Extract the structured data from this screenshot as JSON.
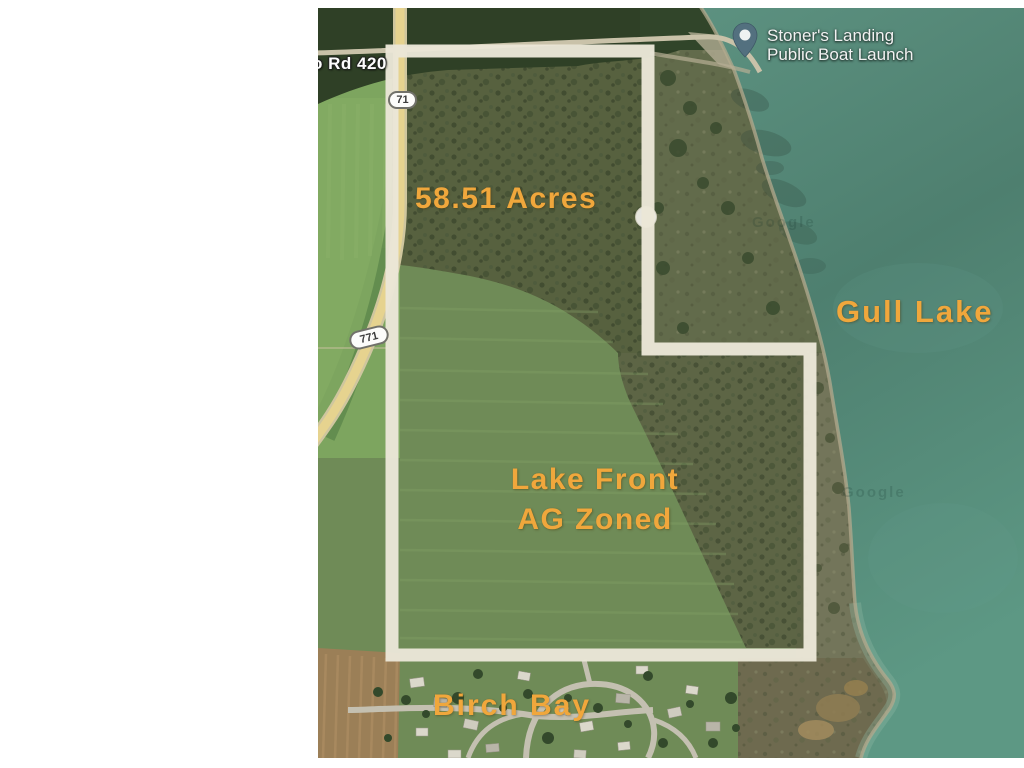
{
  "map": {
    "acreage_label": "58.51 Acres",
    "lake_label": "Gull Lake",
    "zoning_line1": "Lake Front",
    "zoning_line2": "AG Zoned",
    "bay_label": "Birch Bay",
    "poi": {
      "line1": "Stoner's Landing",
      "line2": "Public Boat Launch"
    },
    "road_label": "o Rd 420",
    "route_shield_771": "771",
    "route_shield_71": "71",
    "watermark": "Google",
    "colors": {
      "annotation_gold": "#f0a73c",
      "boundary_outline": "#eae6d7",
      "lake_water": "#4e7f6f",
      "road_tan": "#e6d38f",
      "poi_text": "#f2f2f2",
      "pin_fill": "#53707f",
      "field_green": "#6f8b57",
      "plowed_brown": "#9b7f57"
    }
  }
}
